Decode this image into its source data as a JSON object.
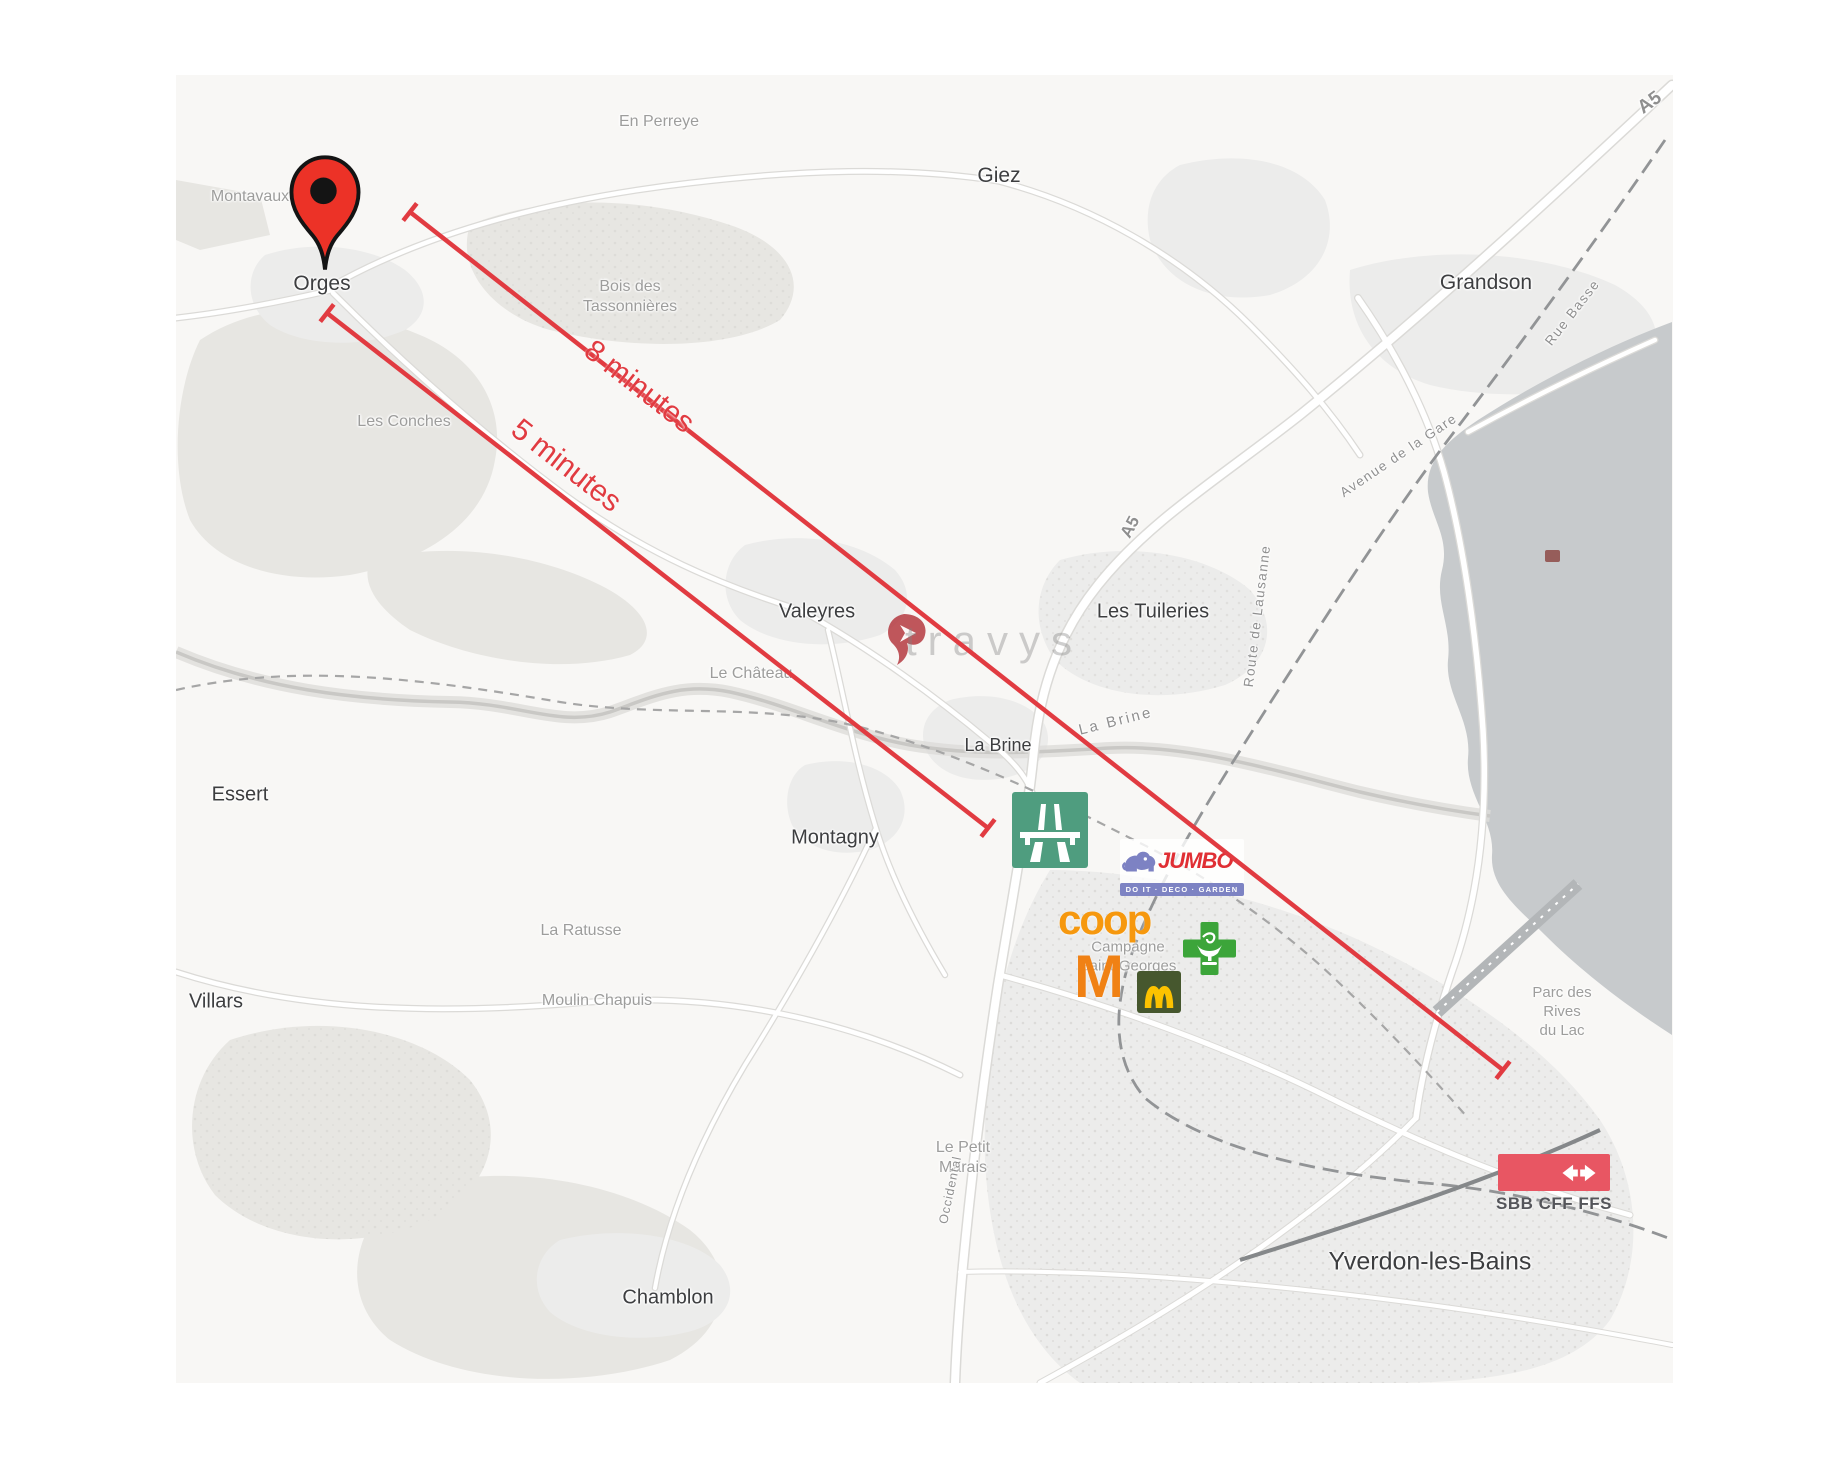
{
  "colors": {
    "accent_red": "#e13b41",
    "pin_red": "#ec3227",
    "highway_green": "#4f9d7f",
    "pharmacy_green": "#3ca53a",
    "migros_orange": "#f08114",
    "coop_orange": "#f6980e",
    "mcdonalds_green": "#46572e",
    "mcdonalds_yellow": "#fcc200",
    "jumbo_red": "#e02f34",
    "jumbo_blue": "#7d83c3",
    "sbb_red": "#e85663",
    "lake_gray": "#c7cacc"
  },
  "annotations": {
    "lines": [
      {
        "id": "drive-8min",
        "label": "8 minutes",
        "x1": 410,
        "y1": 212,
        "x2": 1503,
        "y2": 1070,
        "label_x": 639,
        "label_y": 387,
        "label_rotate": 38
      },
      {
        "id": "drive-5min",
        "label": "5 minutes",
        "x1": 327,
        "y1": 313,
        "x2": 988,
        "y2": 828,
        "label_x": 566,
        "label_y": 466,
        "label_rotate": 38
      }
    ]
  },
  "logos": {
    "travys": {
      "text": "travys"
    },
    "jumbo": {
      "name": "JUMBO",
      "tagline": "DO IT · DECO · GARDEN"
    },
    "coop": {
      "text": "coop"
    },
    "migros": {
      "text": "M"
    },
    "sbb": {
      "text": "SBB CFF FFS"
    }
  },
  "map_labels": {
    "towns": [
      {
        "text": "Orges",
        "x": 322,
        "y": 284,
        "size": 21
      },
      {
        "text": "Giez",
        "x": 999,
        "y": 176,
        "size": 21
      },
      {
        "text": "Grandson",
        "x": 1486,
        "y": 283,
        "size": 21
      },
      {
        "text": "Valeyres",
        "x": 817,
        "y": 612,
        "size": 20
      },
      {
        "text": "Les Tuileries",
        "x": 1153,
        "y": 612,
        "size": 20
      },
      {
        "text": "La Brine",
        "x": 998,
        "y": 745,
        "size": 18
      },
      {
        "text": "Montagny",
        "x": 835,
        "y": 838,
        "size": 20
      },
      {
        "text": "Essert",
        "x": 240,
        "y": 795,
        "size": 20
      },
      {
        "text": "Villars",
        "x": 216,
        "y": 1002,
        "size": 20
      },
      {
        "text": "Chamblon",
        "x": 668,
        "y": 1298,
        "size": 20
      },
      {
        "text": "Yverdon-les-Bains",
        "x": 1430,
        "y": 1262,
        "size": 25
      }
    ],
    "localities": [
      {
        "text": "Montavaux",
        "x": 250,
        "y": 197
      },
      {
        "text": "En Perreye",
        "x": 659,
        "y": 122
      },
      {
        "lines": [
          "Bois des",
          "Tassonnières"
        ],
        "x": 630,
        "y": 297
      },
      {
        "text": "Les Conches",
        "x": 404,
        "y": 422
      },
      {
        "text": "Le Château",
        "x": 751,
        "y": 674
      },
      {
        "text": "La Ratusse",
        "x": 581,
        "y": 931
      },
      {
        "text": "Moulin Chapuis",
        "x": 597,
        "y": 1001
      },
      {
        "lines": [
          "Le Petit",
          "Marais"
        ],
        "x": 963,
        "y": 1158
      },
      {
        "lines": [
          "Campagne",
          "Saint-Georges"
        ],
        "x": 1128,
        "y": 957,
        "size": 15
      },
      {
        "lines": [
          "Parc des",
          "Rives",
          "du Lac"
        ],
        "x": 1562,
        "y": 1012,
        "size": 15
      }
    ],
    "streets": [
      {
        "text": "A5",
        "x": 1650,
        "y": 103,
        "rotate": -36,
        "size": 19,
        "weight": 700
      },
      {
        "text": "A5",
        "x": 1130,
        "y": 527,
        "rotate": -62,
        "size": 17,
        "weight": 700
      },
      {
        "text": "Avenue de la Gare",
        "x": 1399,
        "y": 456,
        "rotate": -34,
        "spacing": 1.5
      },
      {
        "text": "Rue Basse",
        "x": 1573,
        "y": 313,
        "rotate": -52,
        "spacing": 1.5
      },
      {
        "text": "Route de Lausanne",
        "x": 1258,
        "y": 616,
        "rotate": -83,
        "spacing": 1.5
      },
      {
        "text": "La Brine",
        "x": 1116,
        "y": 722,
        "rotate": -14,
        "size": 15,
        "spacing": 2.5
      },
      {
        "text": "Occidental",
        "x": 951,
        "y": 1190,
        "rotate": -78,
        "size": 12.5,
        "spacing": 1
      }
    ]
  }
}
